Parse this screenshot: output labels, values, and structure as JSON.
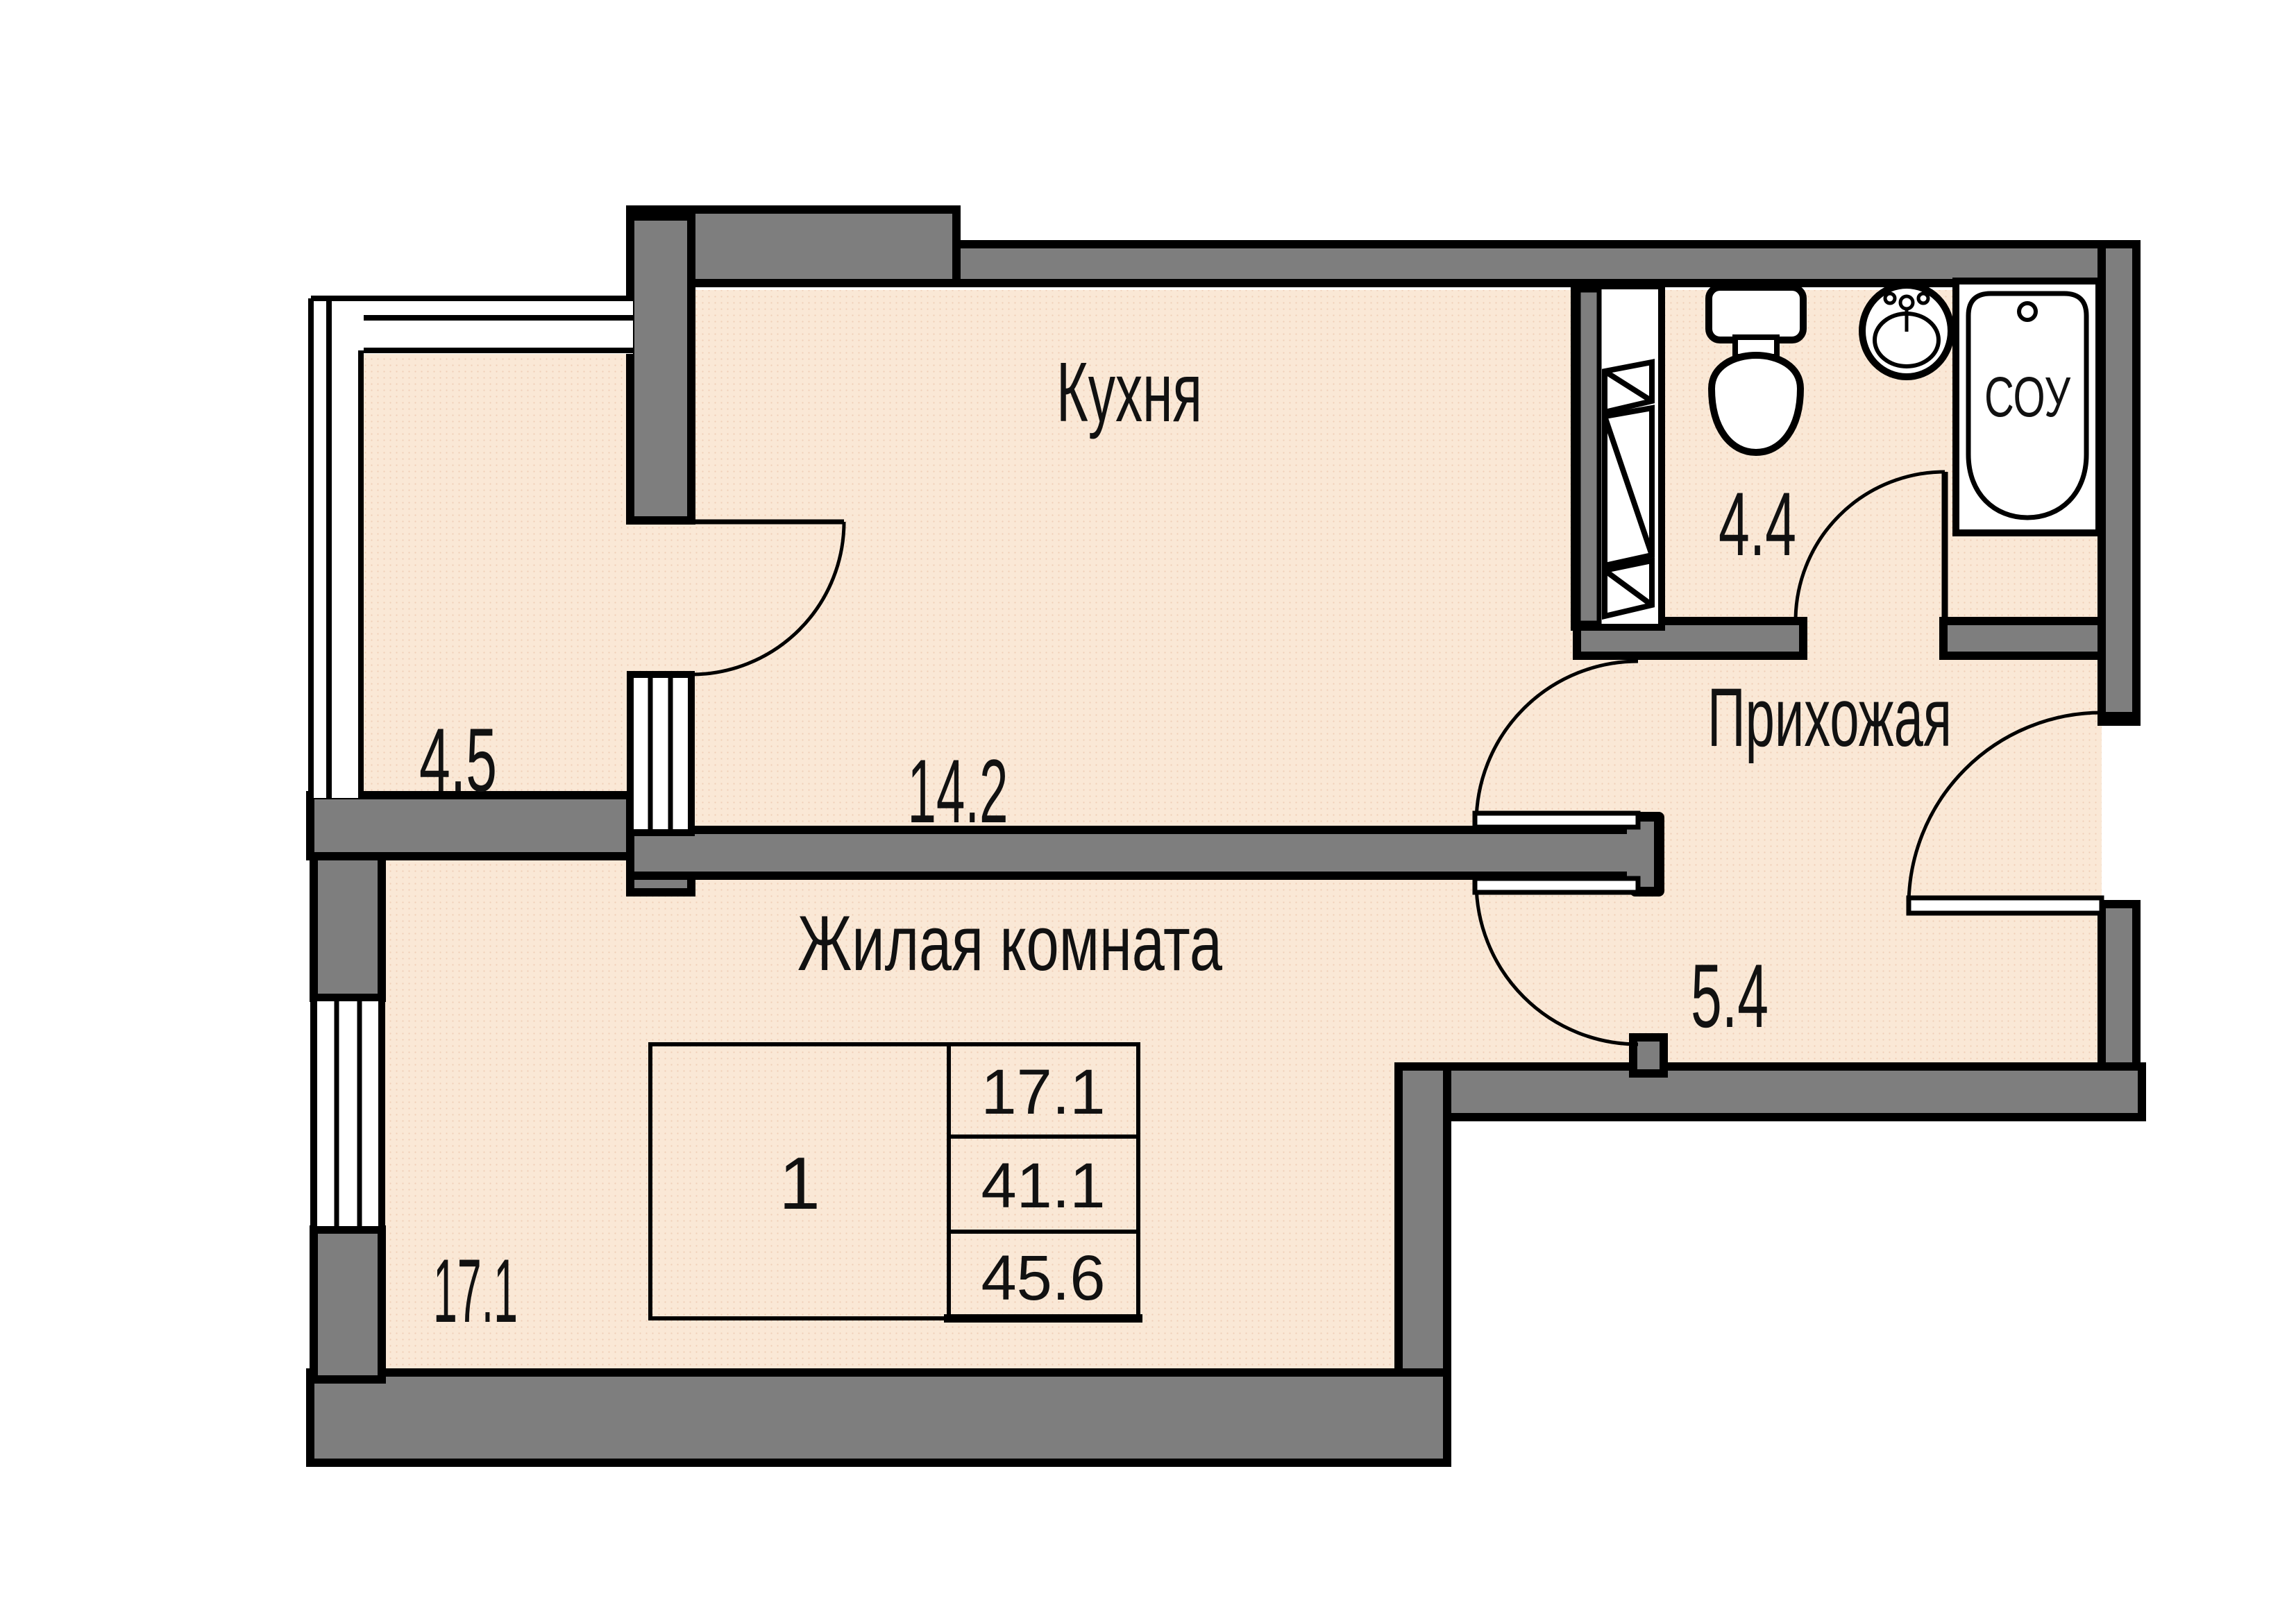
{
  "colors": {
    "floor": "#FAE8D6",
    "floor_dot": "#F0CEB6",
    "wall_gray": "#7E7E7E",
    "outline": "#000000",
    "fixture_white": "#FFFFFF"
  },
  "rooms": {
    "kitchen": {
      "label": "Кухня",
      "area": "14.2"
    },
    "balcony": {
      "area": "4.5"
    },
    "bathroom": {
      "area": "4.4"
    },
    "hallway": {
      "label": "Прихожая",
      "area": "5.4"
    },
    "living_room": {
      "label": "Жилая комната",
      "area": "17.1"
    }
  },
  "fixtures": {
    "bathtub_label": "СОУ"
  },
  "info_table": {
    "rooms_count": "1",
    "living_area": "17.1",
    "area_main": "41.1",
    "area_total": "45.6"
  }
}
